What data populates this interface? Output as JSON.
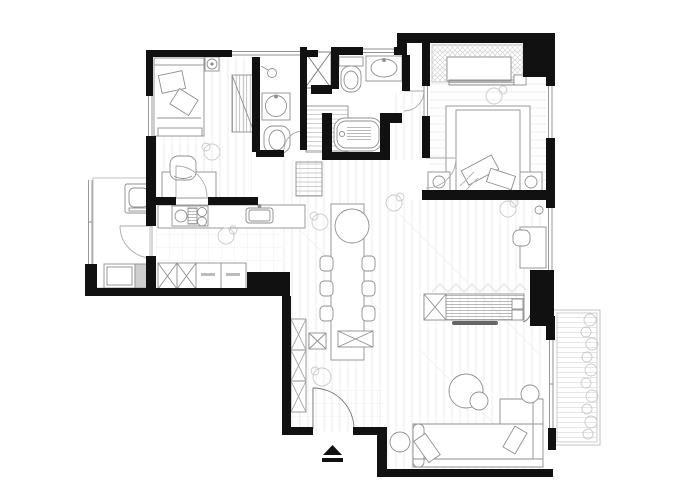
{
  "meta": {
    "title": "apartment-floor-plan",
    "drawing_type": "architectural floor plan, top view, black walls with light furniture linework",
    "visible_text": "none (only illegible micro-labels on two kitchen base cabinets)"
  },
  "colors": {
    "background": "#ffffff",
    "wall": "#111111",
    "line": "#8f8f8f",
    "light_line": "#c9c9c9",
    "floor_line": "#e9e9e9",
    "appliance_fill": "#cfcfcf",
    "tv_fill": "#666666"
  },
  "rooms": [
    {
      "id": "bedroom-1",
      "position": "top-left",
      "furniture": [
        "single-bed",
        "pillows",
        "headboard",
        "foot-bench",
        "nightstand",
        "lamp",
        "striped-wardrobe",
        "desk",
        "desk-chair",
        "plant"
      ]
    },
    {
      "id": "bathroom-1",
      "position": "top-center-left",
      "fixtures": [
        "shower-head",
        "round-washbasin",
        "toilet"
      ]
    },
    {
      "id": "duct-shaft",
      "position": "between-bathrooms",
      "fixtures": [
        "x-crossed-shaft-box"
      ]
    },
    {
      "id": "bathroom-2",
      "position": "top-center",
      "fixtures": [
        "toilet-with-tank",
        "vanity-sink",
        "bathtub-with-mat"
      ]
    },
    {
      "id": "hall",
      "position": "center",
      "fixtures": [
        "shelved-storage-cabinet",
        "low-storage-cabinet"
      ]
    },
    {
      "id": "master-bedroom",
      "position": "top-right",
      "furniture": [
        "hanging-wardrobe",
        "wardrobe-rod",
        "sliding-door",
        "double-bed",
        "pillows",
        "nightstand-left",
        "nightstand-right",
        "lamps",
        "plant"
      ]
    },
    {
      "id": "utility-room",
      "position": "left",
      "appliances": [
        "washing-machine",
        "laundry-counter",
        "grey-appliance"
      ],
      "features": [
        "louver-window",
        "door"
      ]
    },
    {
      "id": "kitchen",
      "position": "center-left",
      "fixtures": [
        "counter",
        "cooktop-two-burners",
        "grate",
        "sink",
        "base-cabinets-x2-crossed",
        "base-cabinets-labeled"
      ]
    },
    {
      "id": "dining-area",
      "position": "center",
      "furniture": [
        "long-dining-table",
        "round-table-end",
        "dining-chairs",
        "bench-x-crossed",
        "stool",
        "plants"
      ],
      "chair_count": 6
    },
    {
      "id": "entry",
      "position": "bottom-center",
      "furniture": [
        "shoe-cabinet-3-sections",
        "entry-door-with-swing-arc",
        "pouf"
      ],
      "floor": "tile-grid"
    },
    {
      "id": "living-room",
      "position": "right",
      "furniture": [
        "tv-console-hatched",
        "tv",
        "l-shaped-sofa",
        "chaise",
        "throw-pillows",
        "coffee-table-large",
        "coffee-table-small",
        "side-table",
        "wall-desk",
        "desk-chair",
        "plants",
        "zigzag-decor"
      ]
    },
    {
      "id": "balcony",
      "position": "right-edge",
      "features": [
        "wood-decking",
        "planter-greenery",
        "sliding-window"
      ]
    }
  ],
  "symbols": {
    "entrance_marker": "solid black triangle above a black bar, below the entry door",
    "windows": "double parallel thin lines in wall openings",
    "doors": "quarter-circle swing arcs with leaf line"
  }
}
